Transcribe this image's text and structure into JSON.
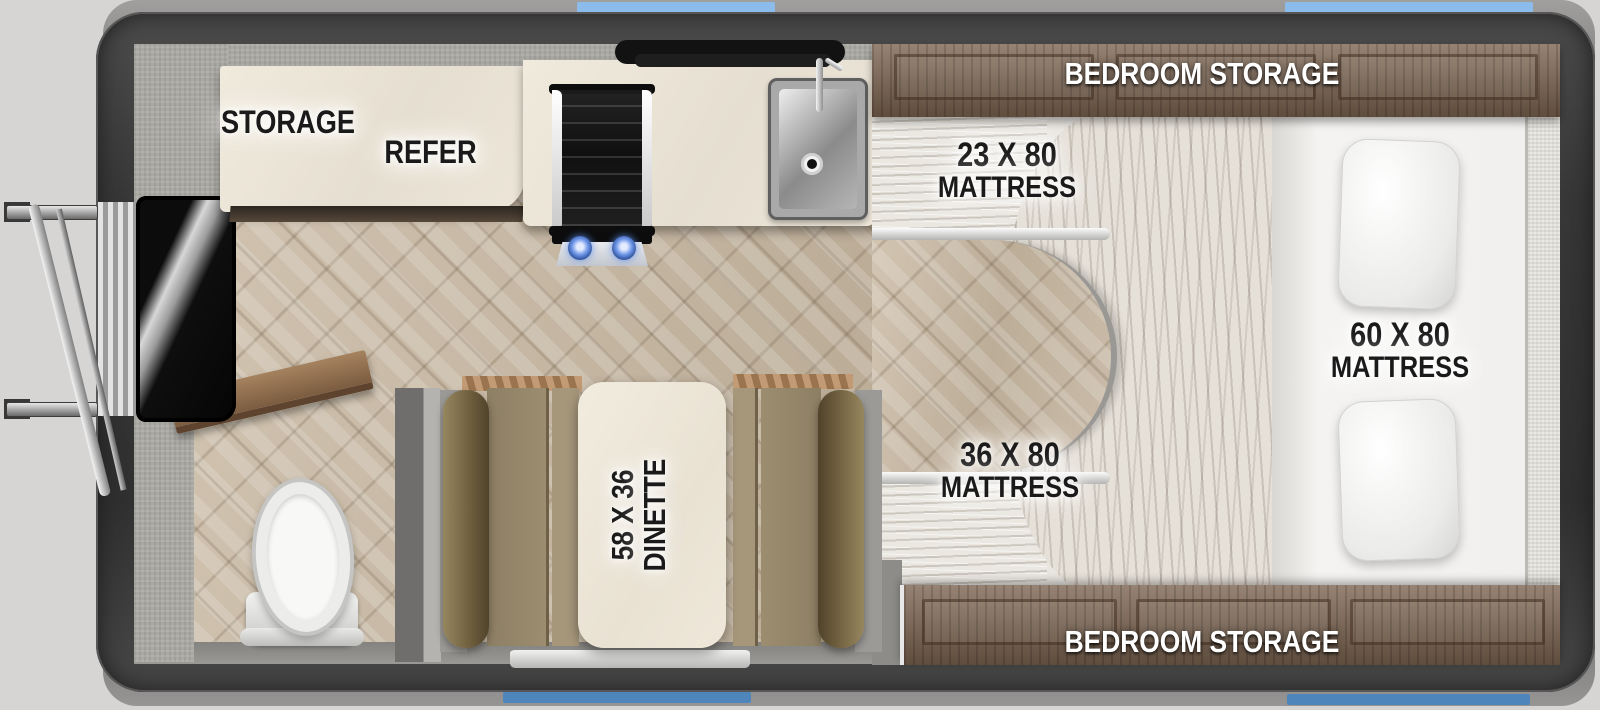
{
  "title": "travel-trailer-floorplan",
  "labels": {
    "storage": "STORAGE",
    "refer": "REFER",
    "bedroom_storage_top": "BEDROOM STORAGE",
    "bedroom_storage_bottom": "BEDROOM STORAGE",
    "mattress_23_line1": "23 X 80",
    "mattress_23_line2": "MATTRESS",
    "mattress_36_line1": "36 X 80",
    "mattress_36_line2": "MATTRESS",
    "mattress_60_line1": "60 X 80",
    "mattress_60_line2": "MATTRESS",
    "dinette_line1": "58 X 36",
    "dinette_line2": "DINETTE"
  },
  "colors": {
    "wall": "#3a3a3a",
    "background": "#d6d5d4",
    "window_top_blue": "#8cbcec",
    "window_bottom_blue": "#4e86bb",
    "floor_wood": "#c8baa7",
    "countertop": "#ece6da",
    "cabinet_wood": "#7c6450",
    "dinette_cushion": "#9c8d70",
    "mattress_white": "#f2f1ef",
    "comforter": "#e5e0d8",
    "burner_blue": "#4d7fd6",
    "label_text_dark": "#1a1a1a",
    "label_text_light": "#ffffff"
  },
  "fixtures": [
    "entry-steps",
    "entry-door",
    "wood-shelf",
    "toilet",
    "range-hood",
    "cooktop",
    "sink",
    "faucet",
    "refrigerator",
    "dinette-table",
    "dinette-bench-left",
    "dinette-bench-right",
    "bed-60x80",
    "pillows",
    "comforter",
    "bunk-23x80",
    "bunk-36x80",
    "windows"
  ]
}
